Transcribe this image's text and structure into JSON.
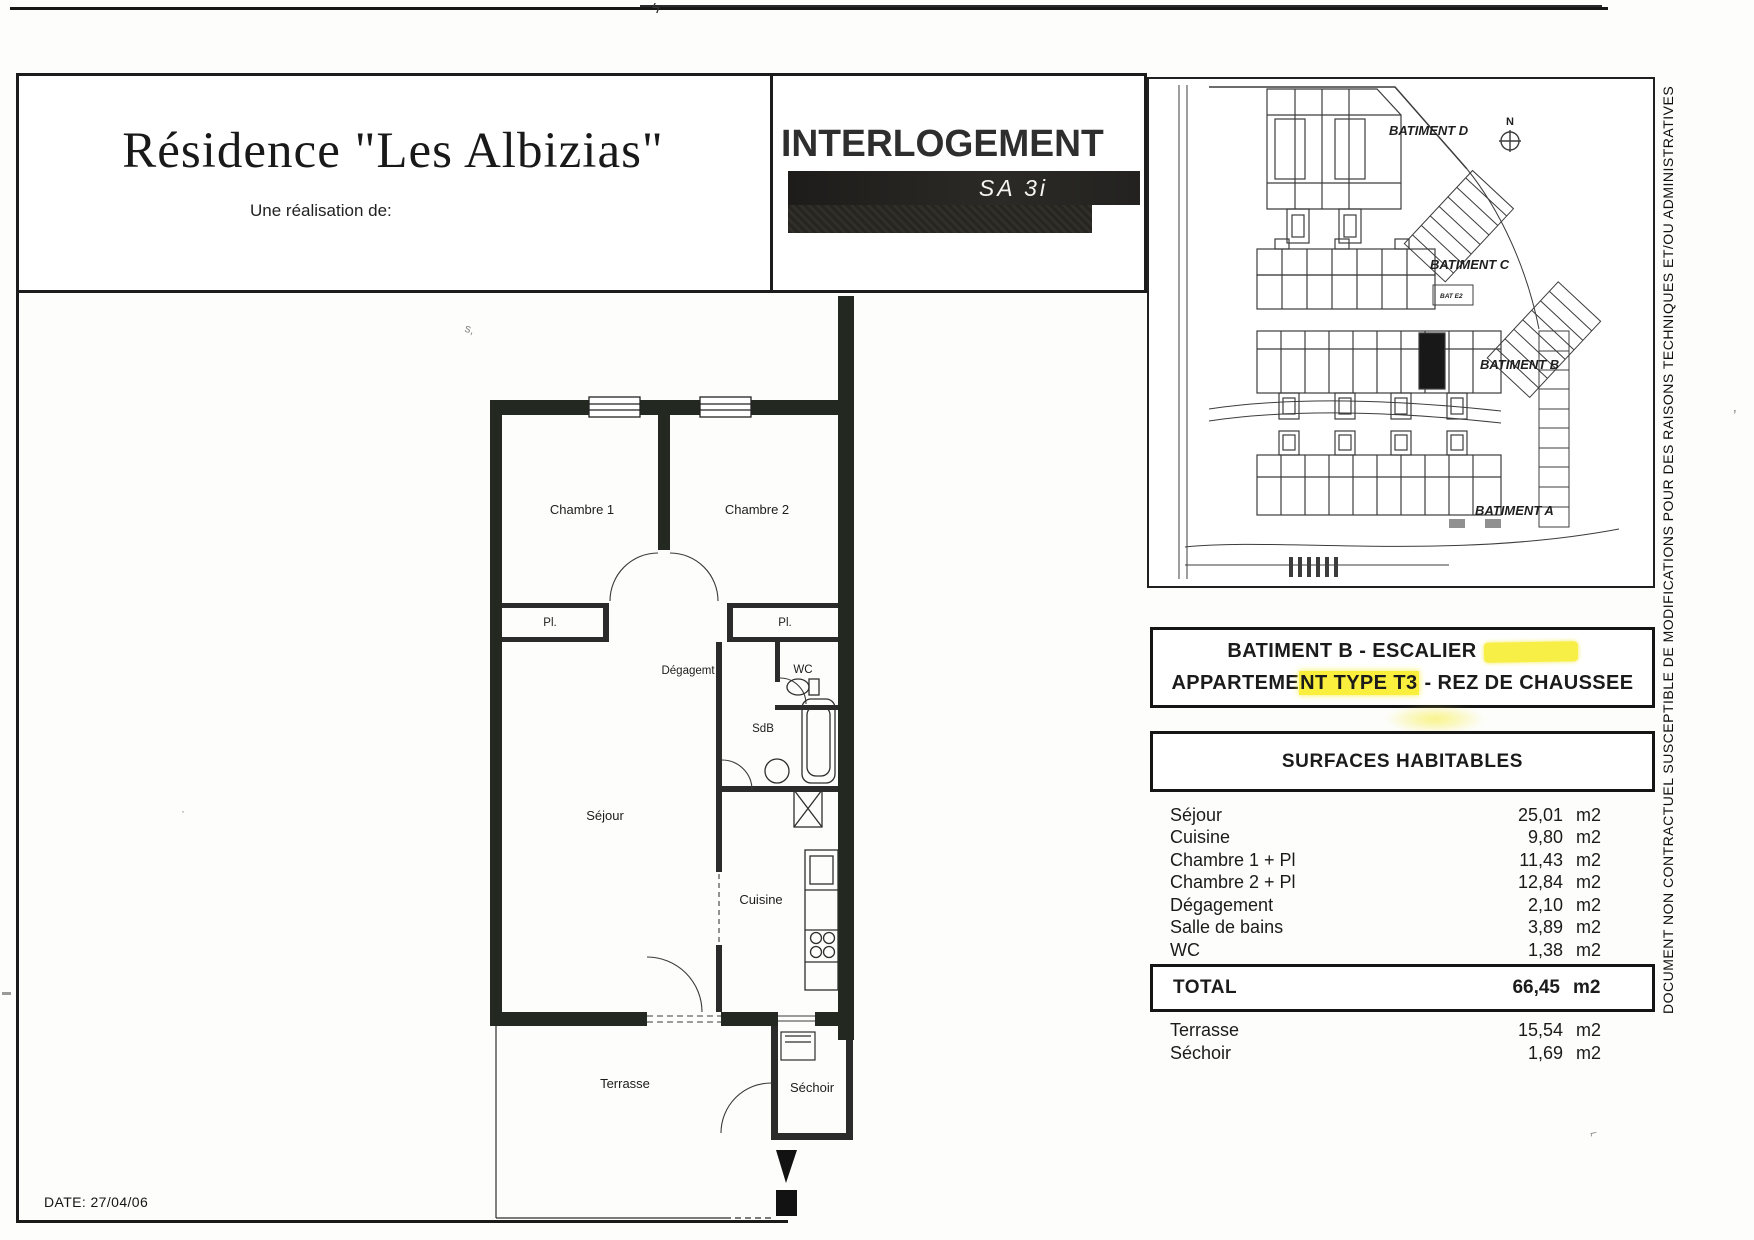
{
  "header": {
    "title": "Résidence \"Les Albizias\"",
    "subtitle": "Une réalisation de:",
    "logo_text": "INTERLOGEMENT",
    "logo_sub": "SA 3i"
  },
  "site_plan": {
    "labels": {
      "bat_d": "BATIMENT D",
      "bat_c": "BATIMENT C",
      "bat_b": "BATIMENT B",
      "bat_a": "BATIMENT A",
      "north": "N",
      "unit_tag": "BAT E2"
    }
  },
  "apartment": {
    "line1": "BATIMENT B - ESCALIER",
    "line2_part1": "APPARTEME",
    "line2_highlight": "NT TYPE T3",
    "line2_part2": "- REZ DE CHAUSSEE"
  },
  "surfaces": {
    "header": "SURFACES HABITABLES",
    "rows": [
      {
        "label": "Séjour",
        "value": "25,01",
        "unit": "m2"
      },
      {
        "label": "Cuisine",
        "value": "9,80",
        "unit": "m2"
      },
      {
        "label": "Chambre 1 + Pl",
        "value": "11,43",
        "unit": "m2"
      },
      {
        "label": "Chambre 2 + Pl",
        "value": "12,84",
        "unit": "m2"
      },
      {
        "label": "Dégagement",
        "value": "2,10",
        "unit": "m2"
      },
      {
        "label": "Salle de bains",
        "value": "3,89",
        "unit": "m2"
      },
      {
        "label": "WC",
        "value": "1,38",
        "unit": "m2"
      }
    ],
    "total": {
      "label": "TOTAL",
      "value": "66,45",
      "unit": "m2"
    },
    "annexes": [
      {
        "label": "Terrasse",
        "value": "15,54",
        "unit": "m2"
      },
      {
        "label": "Séchoir",
        "value": "1,69",
        "unit": "m2"
      }
    ]
  },
  "floor_plan": {
    "labels": {
      "chambre1": "Chambre 1",
      "chambre2": "Chambre 2",
      "pl1": "Pl.",
      "pl2": "Pl.",
      "degagement": "Dégagemt",
      "wc": "WC",
      "sdb": "SdB",
      "sejour": "Séjour",
      "cuisine": "Cuisine",
      "terrasse": "Terrasse",
      "sechoir": "Séchoir"
    }
  },
  "disclaimer": "DOCUMENT NON CONTRACTUEL SUSCEPTIBLE DE MODIFICATIONS POUR DES RAISONS TECHNIQUES ET/OU ADMINISTRATIVES",
  "footer": {
    "date": "DATE: 27/04/06"
  }
}
